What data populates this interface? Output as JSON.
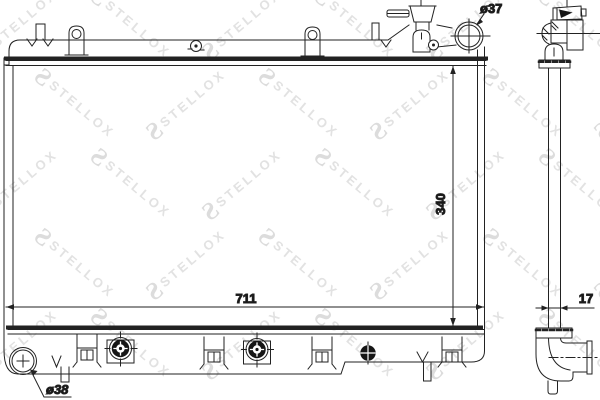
{
  "watermark": {
    "logo": "S",
    "text": "STELLOX"
  },
  "labels": {
    "filler_neck_diameter": "ø37",
    "outlet_diameter": "ø38",
    "core_height_mm": "340",
    "core_width_mm": "711",
    "core_depth_mm": "17"
  }
}
